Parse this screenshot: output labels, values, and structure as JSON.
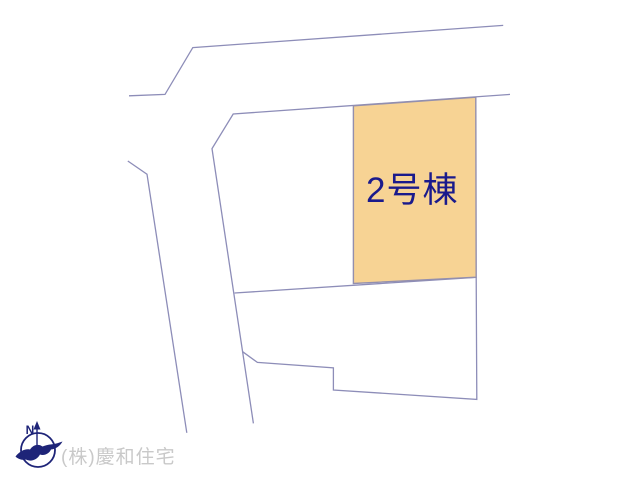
{
  "diagram": {
    "parcel_label": "2号棟",
    "company_label": "(株)慶和住宅",
    "compass_label": "N"
  },
  "colors": {
    "background": "#ffffff",
    "road_line": "#8d8db8",
    "parcel_fill": "#f7d394",
    "parcel_border": "#938fae",
    "parcel_text": "#1a1a8c",
    "compass_navy": "#1e2478",
    "company_text": "#c9c9c9"
  },
  "geometry": {
    "road_top_left": "129,95.8 165,94.4 192.8,47.6 503.2,25.4",
    "road_right_edge": "510,94.4 233.2,114 212,148.6 253.4,423.4",
    "road_left_edge": "127.8,161 147,174.2 186.8,432.8",
    "parcel_divider": "234.6,293 476,277.3",
    "lower_parcel_boundary": "242.8,351.8 257.4,362.4 333.4,367.8 333.4,390 476.8,399.4 476.2,277.3",
    "parcel_points": "353.4,105.8 475.8,97.2 476.2,277.2 353.4,283.5",
    "compass_bird_path": "M2.5,40.5 C7,35 12,32.5 17,33.5 C20,28.5 26,27.5 29.5,30.5 C35,28 42,28.5 46.5,26.5 L49.5,25.5 C47,30 43,33 38,33.5 C36,38 31,40 27,38.5 C24,44 18,46 13,43.5 C9,44.5 5,43 2.5,40.5 Z",
    "compass_needle_head": "24,5 20.5,13.5 27.5,13.5"
  }
}
